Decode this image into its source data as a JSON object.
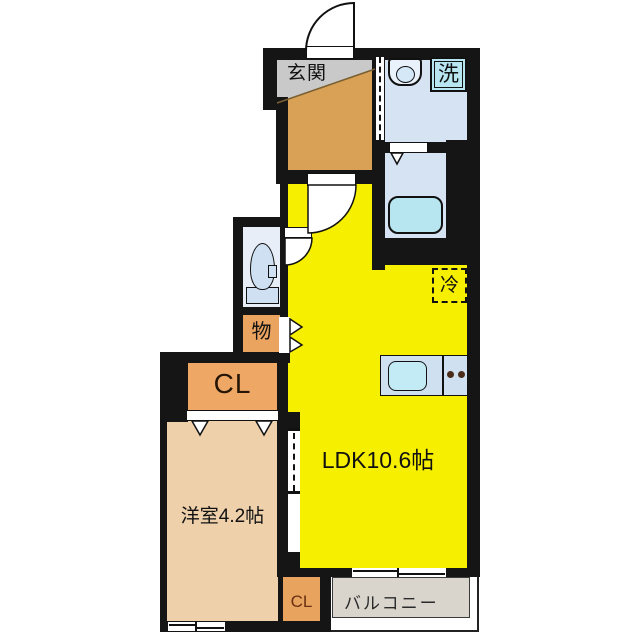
{
  "plan": {
    "rooms": {
      "genkan": {
        "label": "玄関"
      },
      "washroom": {
        "washer_label": "洗"
      },
      "storage": {
        "label": "物"
      },
      "closet_upper": {
        "label": "CL"
      },
      "western_room": {
        "label": "洋室4.2帖"
      },
      "ldk": {
        "label": "LDK10.6帖",
        "fridge_label": "冷"
      },
      "closet_lower": {
        "label": "CL"
      },
      "balcony": {
        "label": "バルコニー"
      }
    },
    "colors": {
      "wall": "#151515",
      "ldk_yellow": "#f7ef00",
      "room_tan": "#eed0ab",
      "closet_orange": "#efa765",
      "genkan_orange": "#d9a156",
      "genkan_gray": "#c9c9c9",
      "wet_floor_blue": "#d5e3f3",
      "fixture_cyan": "#b7e6f1",
      "balcony_gray": "#d9d5cd"
    }
  }
}
